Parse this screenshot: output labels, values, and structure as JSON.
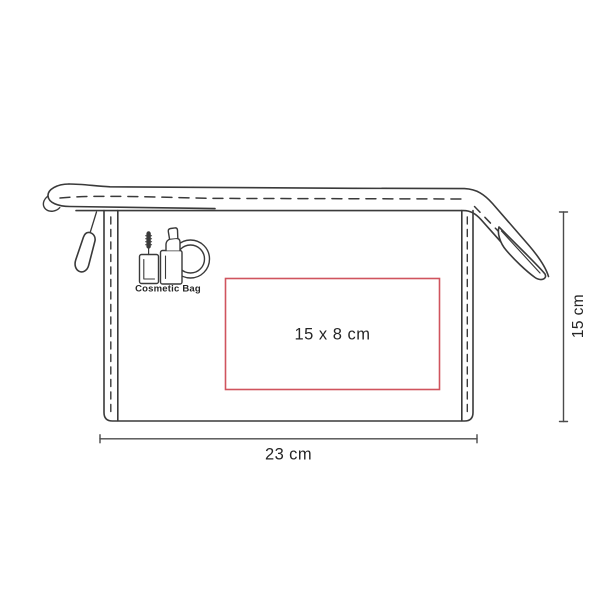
{
  "colors": {
    "line": "#3a3a3a",
    "dimension": "#4b4b4b",
    "text": "#262626",
    "print_area_border": "#d0545e",
    "background": "#ffffff"
  },
  "bag": {
    "logo": {
      "icon": "cosmetics-icon",
      "label": "Cosmetic Bag"
    }
  },
  "print_area": {
    "label": "15 x 8 cm"
  },
  "dimensions": {
    "width": {
      "label": "23 cm"
    },
    "height": {
      "label": "15 cm"
    }
  }
}
